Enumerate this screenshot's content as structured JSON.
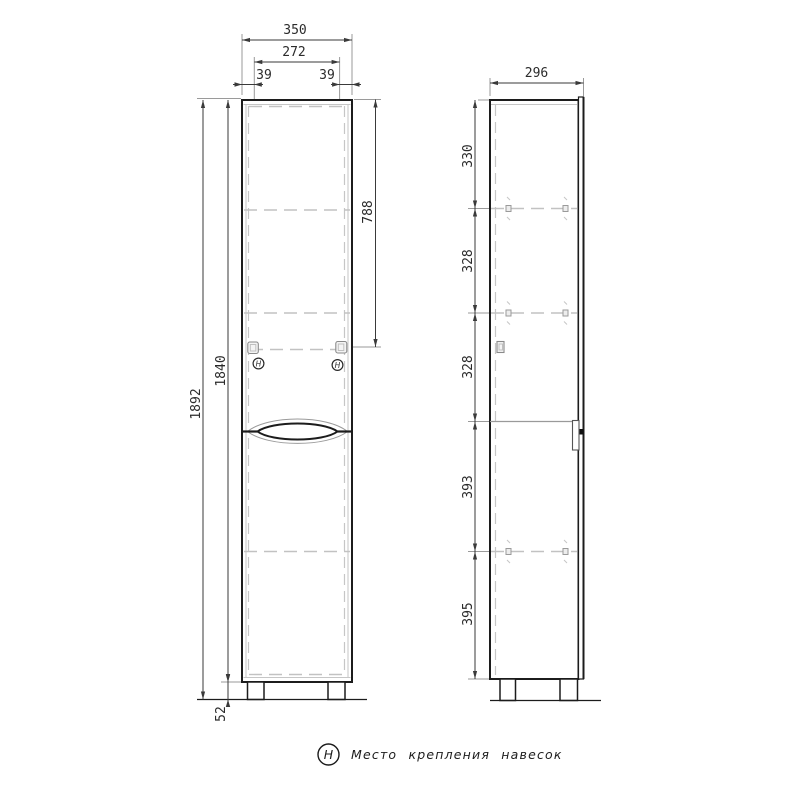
{
  "drawing": {
    "title_hint": "cabinet-technical-drawing",
    "front_view": {
      "dims": {
        "overall_width": "350",
        "hinge_span": "272",
        "hinge_offset_left": "39",
        "hinge_offset_right": "39",
        "total_height": "1892",
        "body_height": "1840",
        "hinge_from_top": "788",
        "leg_height": "52"
      },
      "hinge_marker": "H"
    },
    "side_view": {
      "dims": {
        "depth": "296",
        "sections": [
          "330",
          "328",
          "328",
          "393",
          "395"
        ]
      }
    },
    "legend": {
      "symbol": "H",
      "label": "Место крепления навесок"
    },
    "colors": {
      "outline": "#1c1c1c",
      "dimension": "#3a3a3a",
      "hidden_line": "#c2c2c2",
      "background": "#ffffff"
    }
  }
}
